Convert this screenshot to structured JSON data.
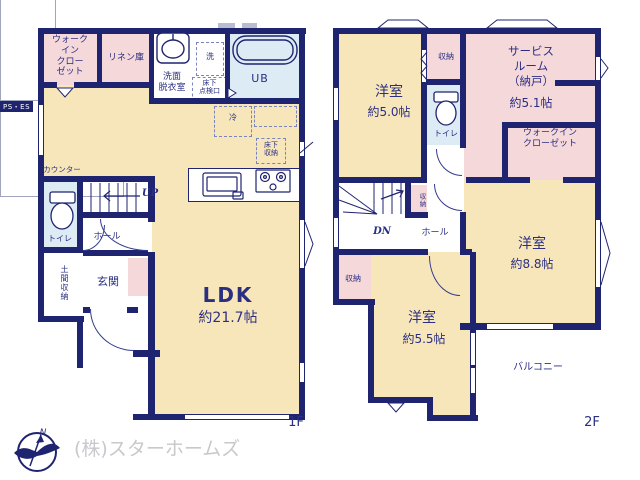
{
  "colors": {
    "wall": "#1f2470",
    "text": "#2a2f82",
    "cream": "#f8e6bb",
    "pink": "#f5d8da",
    "blue": "#dcebf4",
    "gray_text": "#c8c8cd"
  },
  "f1": {
    "floor_label": "1F",
    "wic": "ウォーク\nイン\nクロー\nゼット",
    "linen": "リネン庫",
    "ps_es": "PS・ES",
    "washer": "洗",
    "senmen": "洗面\n脱衣室",
    "tenkenko": "床下\n点検口",
    "ub": "UB",
    "rei": "冷",
    "yukashita": "床下\n収納",
    "counter": "カウンター",
    "up": "UP",
    "toilet": "トイレ",
    "hall": "ホール",
    "doma": "土間収納",
    "genkan": "玄関",
    "ldk_name": "LDK",
    "ldk_size": "約21.7帖"
  },
  "f2": {
    "floor_label": "2F",
    "y50_name": "洋室",
    "y50_size": "約5.0帖",
    "shuno_top": "収納",
    "toilet": "トイレ",
    "service_name": "サービス\nルーム\n（納戸）",
    "service_size": "約5.1帖",
    "wic": "ウォークイン\nクローゼット",
    "y88_name": "洋室",
    "y88_size": "約8.8帖",
    "dn": "DN",
    "shuno_mid": "収納",
    "hall": "ホール",
    "shuno_left": "収納",
    "y55_name": "洋室",
    "y55_size": "約5.5帖",
    "balcony": "バルコニー"
  },
  "footer": {
    "company": "(株)スターホームズ",
    "north": "N"
  }
}
